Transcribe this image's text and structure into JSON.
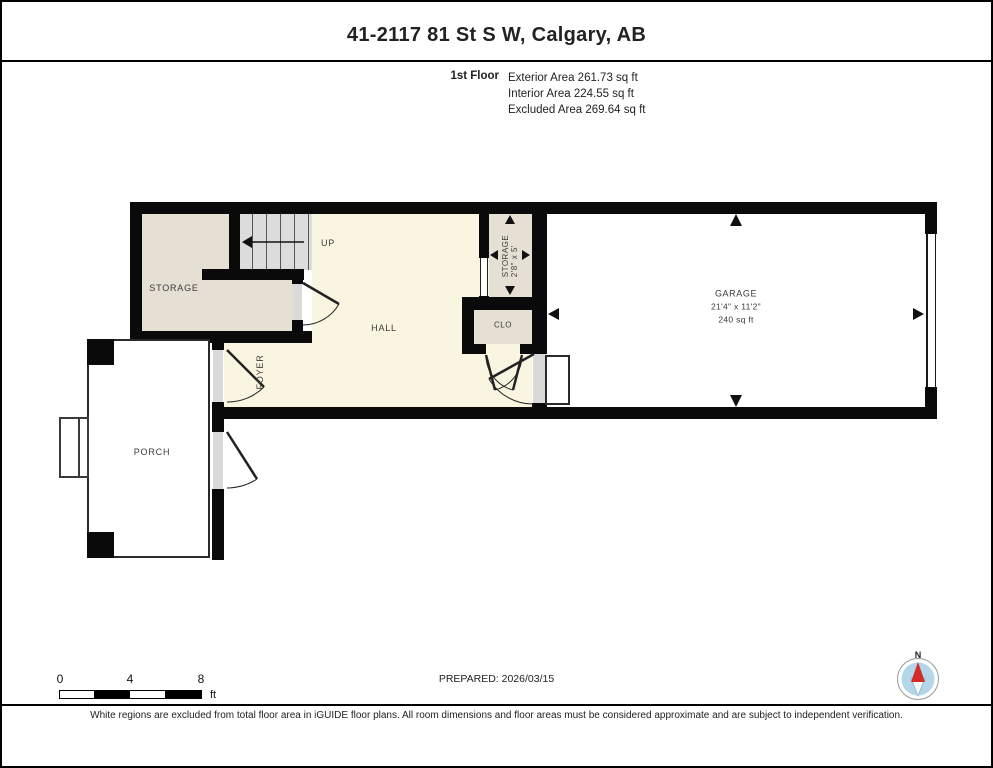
{
  "header": {
    "title": "41-2117 81 St S W, Calgary, AB",
    "floor_label": "1st Floor",
    "areas": [
      "Exterior Area 261.73 sq ft",
      "Interior Area 224.55 sq ft",
      "Excluded Area 269.64 sq ft"
    ]
  },
  "plan": {
    "rooms": {
      "storage": {
        "label": "STORAGE"
      },
      "stairs": {
        "direction": "UP"
      },
      "hall": {
        "label": "HALL"
      },
      "foyer": {
        "label": "FOYER"
      },
      "closet": {
        "label": "CLO"
      },
      "storage2": {
        "label": "STORAGE",
        "dims": "2'8\" x 5'"
      },
      "garage": {
        "label": "GARAGE",
        "dims": "21'4\" x 11'2\"",
        "area": "240 sq ft"
      },
      "porch": {
        "label": "PORCH"
      }
    }
  },
  "footer": {
    "scale": {
      "tick0": "0",
      "tick4": "4",
      "tick8": "8",
      "unit": "ft"
    },
    "prepared": "PREPARED: 2026/03/15",
    "compass": {
      "north_label": "N"
    },
    "disclaimer": "White regions are excluded from total floor area in iGUIDE floor plans. All room dimensions and floor areas must be considered approximate and are subject to independent verification."
  },
  "colors": {
    "wall": "#0a0a0a",
    "interior_cream": "#faf5e1",
    "room_beige": "#e6dfd3",
    "stairs_gray": "#dcdcdc",
    "excluded_white": "#ffffff",
    "compass_blue": "#b3d6e8",
    "compass_red": "#d32b27"
  }
}
